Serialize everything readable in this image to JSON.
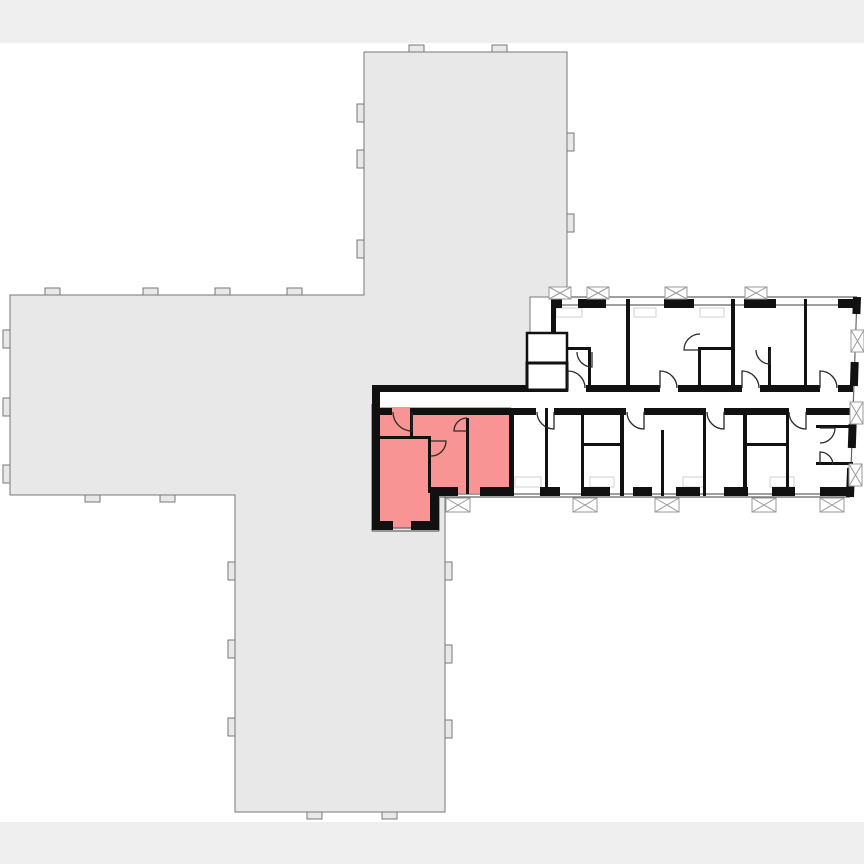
{
  "page": {
    "title": "building-floor-plan",
    "band_color": "#efefef",
    "canvas_color": "#ffffff"
  },
  "floorplan": {
    "colors": {
      "building_fill": "#e8e8e8",
      "building_stroke": "#777777",
      "room_fill": "#ffffff",
      "wall": "#111111",
      "thin_line": "#666666",
      "column_stroke": "#9a9a9a",
      "furniture": "#d0d0d0",
      "arc": "#2a2a2a",
      "highlight_fill": "#f89494"
    },
    "building_outline": [
      [
        364,
        52
      ],
      [
        567,
        52
      ],
      [
        567,
        297
      ],
      [
        530,
        297
      ],
      [
        530,
        388
      ],
      [
        445,
        388
      ],
      [
        445,
        812
      ],
      [
        235,
        812
      ],
      [
        235,
        495
      ],
      [
        10,
        495
      ],
      [
        10,
        295
      ],
      [
        364,
        295
      ]
    ],
    "pilasters": [
      [
        409,
        45,
        15,
        7
      ],
      [
        492,
        45,
        15,
        7
      ],
      [
        45,
        288,
        15,
        7
      ],
      [
        143,
        288,
        15,
        7
      ],
      [
        215,
        288,
        15,
        7
      ],
      [
        287,
        288,
        15,
        7
      ],
      [
        357,
        104,
        7,
        18
      ],
      [
        357,
        150,
        7,
        18
      ],
      [
        357,
        240,
        7,
        18
      ],
      [
        567,
        133,
        7,
        18
      ],
      [
        567,
        214,
        7,
        18
      ],
      [
        3,
        330,
        7,
        18
      ],
      [
        3,
        398,
        7,
        18
      ],
      [
        3,
        465,
        7,
        18
      ],
      [
        85,
        495,
        15,
        7
      ],
      [
        160,
        495,
        15,
        7
      ],
      [
        228,
        562,
        7,
        18
      ],
      [
        228,
        640,
        7,
        18
      ],
      [
        228,
        718,
        7,
        18
      ],
      [
        445,
        562,
        7,
        18
      ],
      [
        445,
        645,
        7,
        18
      ],
      [
        445,
        720,
        7,
        18
      ],
      [
        307,
        812,
        15,
        7
      ],
      [
        382,
        812,
        15,
        7
      ]
    ],
    "white_rects": [
      [
        553,
        299,
        300,
        91
      ],
      [
        512,
        408,
        338,
        88
      ],
      [
        377,
        390,
        476,
        20
      ]
    ],
    "highlight_polygon": "374,407 511,407 511,493 430,493 430,528 374,528",
    "thin_lines": [
      [
        551,
        297,
        857,
        297
      ],
      [
        857,
        297,
        850,
        497
      ],
      [
        850,
        497,
        439,
        497
      ],
      [
        439,
        497,
        439,
        531
      ],
      [
        439,
        531,
        372,
        531
      ],
      [
        372,
        531,
        372,
        404
      ],
      [
        562,
        305,
        578,
        305
      ],
      [
        606,
        305,
        664,
        305
      ],
      [
        694,
        305,
        744,
        305
      ],
      [
        776,
        305,
        838,
        305
      ],
      [
        455,
        494,
        480,
        494
      ],
      [
        512,
        494,
        540,
        494
      ],
      [
        560,
        494,
        584,
        494
      ],
      [
        610,
        494,
        633,
        494
      ],
      [
        652,
        494,
        676,
        494
      ],
      [
        700,
        494,
        724,
        494
      ],
      [
        748,
        494,
        772,
        494
      ],
      [
        795,
        494,
        820,
        494
      ],
      [
        393,
        528,
        411,
        528
      ],
      [
        532,
        339,
        562,
        339
      ],
      [
        532,
        345,
        562,
        345
      ],
      [
        532,
        351,
        562,
        351
      ],
      [
        532,
        357,
        562,
        357
      ]
    ],
    "black_rects": [
      [
        551,
        299,
        11,
        9
      ],
      [
        578,
        299,
        28,
        9
      ],
      [
        664,
        299,
        30,
        9
      ],
      [
        744,
        299,
        32,
        9
      ],
      [
        838,
        299,
        19,
        9
      ],
      [
        377,
        385,
        191,
        7
      ],
      [
        586,
        385,
        74,
        7
      ],
      [
        678,
        385,
        64,
        7
      ],
      [
        760,
        385,
        60,
        7
      ],
      [
        838,
        385,
        15,
        7
      ],
      [
        372,
        408,
        20,
        7
      ],
      [
        410,
        408,
        126,
        7
      ],
      [
        554,
        408,
        72,
        7
      ],
      [
        644,
        408,
        62,
        7
      ],
      [
        724,
        408,
        64,
        7
      ],
      [
        806,
        408,
        47,
        7
      ],
      [
        431,
        487,
        27,
        9
      ],
      [
        480,
        487,
        32,
        9
      ],
      [
        540,
        487,
        20,
        9
      ],
      [
        584,
        487,
        26,
        9
      ],
      [
        633,
        487,
        19,
        9
      ],
      [
        676,
        487,
        24,
        9
      ],
      [
        724,
        487,
        24,
        9
      ],
      [
        772,
        487,
        23,
        9
      ],
      [
        820,
        487,
        31,
        9
      ],
      [
        372,
        521,
        21,
        9
      ],
      [
        411,
        521,
        28,
        9
      ],
      [
        372,
        404,
        8,
        126
      ],
      [
        430,
        487,
        9,
        43
      ],
      [
        509,
        408,
        5,
        88
      ],
      [
        410,
        411,
        3,
        27
      ],
      [
        428,
        436,
        3,
        57
      ],
      [
        466,
        418,
        3,
        76
      ],
      [
        374,
        436,
        57,
        3
      ],
      [
        372,
        385,
        8,
        23
      ],
      [
        551,
        299,
        5,
        41
      ],
      [
        626,
        299,
        4,
        91
      ],
      [
        731,
        299,
        4,
        91
      ],
      [
        804,
        299,
        3,
        91
      ],
      [
        588,
        347,
        3,
        43
      ],
      [
        698,
        347,
        3,
        43
      ],
      [
        768,
        347,
        3,
        43
      ],
      [
        553,
        347,
        38,
        3
      ],
      [
        701,
        347,
        30,
        3
      ],
      [
        545,
        408,
        3,
        88
      ],
      [
        581,
        408,
        3,
        88
      ],
      [
        620,
        408,
        4,
        88
      ],
      [
        661,
        430,
        3,
        66
      ],
      [
        703,
        408,
        3,
        88
      ],
      [
        743,
        408,
        4,
        88
      ],
      [
        786,
        408,
        3,
        88
      ],
      [
        816,
        425,
        37,
        3
      ],
      [
        816,
        462,
        37,
        3
      ],
      [
        581,
        443,
        42,
        3
      ],
      [
        743,
        443,
        46,
        3
      ]
    ],
    "slant_walls": [
      [
        857,
        297,
        856.4,
        314
      ],
      [
        854.7,
        362,
        853.9,
        386
      ],
      [
        852.6,
        424,
        851.8,
        448
      ],
      [
        851.1,
        468,
        850,
        497
      ]
    ],
    "core_rooms": [
      [
        527,
        333,
        40,
        30,
        2.5
      ],
      [
        527,
        363,
        40,
        27,
        3
      ]
    ],
    "columns_hatched": [
      [
        549,
        287,
        22,
        12
      ],
      [
        587,
        287,
        22,
        12
      ],
      [
        665,
        287,
        22,
        12
      ],
      [
        745,
        287,
        22,
        12
      ],
      [
        446,
        498,
        24,
        14
      ],
      [
        573,
        498,
        24,
        14
      ],
      [
        655,
        498,
        24,
        14
      ],
      [
        752,
        498,
        24,
        14
      ],
      [
        820,
        498,
        24,
        14
      ],
      [
        851,
        330,
        13,
        22
      ],
      [
        850,
        402,
        13,
        22
      ],
      [
        849,
        464,
        13,
        22
      ]
    ],
    "door_arcs": [
      [
        412,
        412,
        19,
        90,
        180
      ],
      [
        431,
        441,
        15,
        0,
        90
      ],
      [
        467,
        431,
        13,
        180,
        270
      ],
      [
        554,
        412,
        17,
        90,
        180
      ],
      [
        644,
        412,
        17,
        90,
        180
      ],
      [
        724,
        412,
        17,
        90,
        180
      ],
      [
        806,
        412,
        17,
        90,
        180
      ],
      [
        568,
        388,
        17,
        270,
        360
      ],
      [
        660,
        388,
        17,
        270,
        360
      ],
      [
        742,
        388,
        17,
        270,
        360
      ],
      [
        820,
        388,
        17,
        270,
        360
      ],
      [
        592,
        352,
        15,
        90,
        180
      ],
      [
        700,
        350,
        16,
        180,
        270
      ],
      [
        770,
        350,
        14,
        90,
        180
      ],
      [
        820,
        428,
        15,
        0,
        90
      ],
      [
        820,
        465,
        13,
        270,
        360
      ]
    ],
    "furniture": [
      [
        515,
        477,
        26,
        10
      ],
      [
        590,
        477,
        24,
        10
      ],
      [
        683,
        477,
        22,
        10
      ],
      [
        770,
        477,
        24,
        10
      ],
      [
        556,
        308,
        26,
        9
      ],
      [
        634,
        308,
        22,
        9
      ],
      [
        700,
        308,
        24,
        9
      ]
    ]
  }
}
